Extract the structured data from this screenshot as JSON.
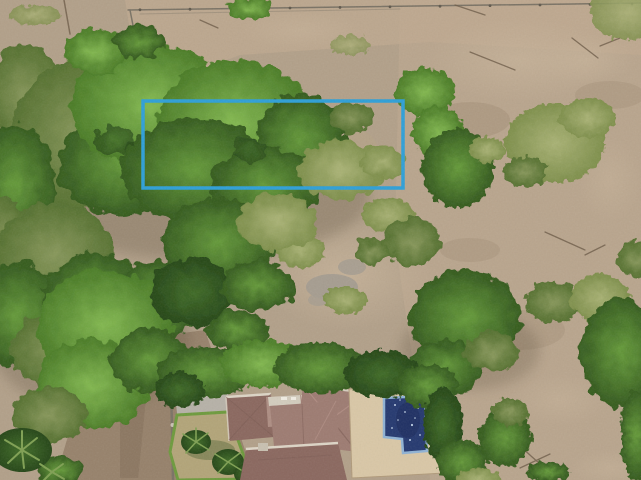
{
  "scene": {
    "type": "aerial-drone-photograph",
    "description": "Top-down drone view of a wooded vacant lot outlined with a blue boundary rectangle, dry scrub field to the right, and a tile-roof house with swimming pool at the bottom",
    "palette": {
      "dirt_base": "#b2a089",
      "dirt_light": "#c8b49a",
      "dirt_pink": "#c0aa90",
      "dirt_path": "#97826b",
      "dirt_dark": "#86705a",
      "stone_gray": "#a69d90",
      "canopy_bright": "#82b84f",
      "canopy_bright_edge": "#4a7b26",
      "canopy_mid": "#659a39",
      "canopy_mid_edge": "#33591d",
      "canopy_olive": "#87975a",
      "canopy_olive_edge": "#55702f",
      "canopy_sage": "#a9b274",
      "canopy_sage_edge": "#7e8f4b",
      "canopy_deep": "#3f6b26",
      "canopy_shadow": "#244516",
      "ground_shadow": "#4a3c2c",
      "fence_gray": "#7a7264",
      "twig_brown": "#6e5c48",
      "palm_frond": "#7fa052",
      "roof_main": "#9d7b71",
      "roof_dark": "#8a675e",
      "roof_light": "#ad8d82",
      "roof_ridge_dark": "#7b5b53",
      "roof_ridge_light": "#b59288",
      "roof_trim": "#ddd5c6",
      "concrete": "#b6b1a7",
      "patio_cream": "#d9c7a6",
      "lawn": "#b2a478",
      "hedge_green": "#6d9a3c",
      "pool_water": "#24386f",
      "pool_water_deep": "#1a2a5c",
      "pool_tile": "#8fb2d4",
      "pool_sparkle": "#cfe0f2",
      "terracotta": "#9c5348"
    },
    "boundary": {
      "x": 143,
      "y": 101,
      "width": 260,
      "height": 87,
      "color": "#2d9fd8",
      "stroke_width": 3.5
    }
  }
}
